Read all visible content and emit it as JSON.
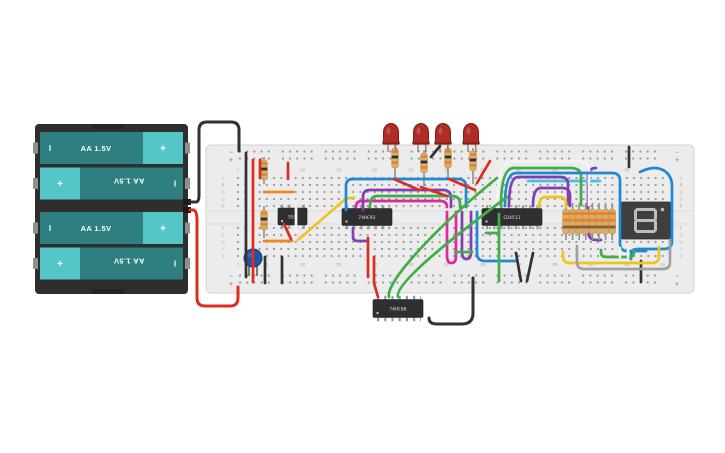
{
  "scene": {
    "background": "#ffffff",
    "width": 725,
    "height": 453
  },
  "battery": {
    "cell_label": "AA 1.5V",
    "plus_symbol": "+",
    "minus_symbol": "I",
    "cells": [
      {
        "flipped": false
      },
      {
        "flipped": true
      },
      {
        "flipped": false
      },
      {
        "flipped": true
      }
    ],
    "colors": {
      "holder": "#2e2e2e",
      "body": "#2e7f80",
      "cap": "#55c6c8"
    }
  },
  "breadboard": {
    "row_labels_top": [
      "A",
      "B",
      "C",
      "D",
      "E"
    ],
    "row_labels_bottom": [
      "F",
      "G",
      "H",
      "I",
      "J"
    ],
    "column_numbers": [
      1,
      5,
      10,
      15,
      20,
      25,
      30,
      35,
      40,
      45,
      50,
      55,
      60
    ],
    "rail_minus": "−",
    "rail_plus": "+",
    "colors": {
      "board": "#ececec",
      "hole": "#9c9c9c",
      "minus": "#5ba0d0",
      "plus": "#d05a5a"
    }
  },
  "circuit": {
    "ics": [
      {
        "id": "timer-555",
        "label": "555"
      },
      {
        "id": "counter-74hc93",
        "label": "74HC93"
      },
      {
        "id": "decoder-cd4511",
        "label": "CD4511"
      },
      {
        "id": "and-gate-74hc08",
        "label": "74HC08"
      }
    ],
    "display": {
      "type": "seven-segment-display",
      "unlit_segments": "all",
      "unlit_color": "#bdbdbd",
      "body_color": "#3f3f41"
    },
    "led_color": "#ad2c24",
    "leds": [
      {
        "x": 391
      },
      {
        "x": 421
      },
      {
        "x": 443
      },
      {
        "x": 471
      }
    ],
    "resistors": [
      {
        "x": 395,
        "lead": [
          145,
          180
        ],
        "body": [
          148,
          20
        ]
      },
      {
        "x": 424,
        "lead": [
          150,
          186
        ],
        "body": [
          153,
          20
        ]
      },
      {
        "x": 448,
        "lead": [
          145,
          180
        ],
        "body": [
          148,
          20
        ]
      },
      {
        "x": 473,
        "lead": [
          148,
          184
        ],
        "body": [
          151,
          20
        ]
      },
      {
        "x": 264,
        "lead": [
          157,
          184
        ],
        "body": [
          160,
          20
        ]
      },
      {
        "x": 264,
        "lead": [
          206,
          238
        ],
        "body": [
          210,
          20
        ]
      }
    ],
    "resistor_bands": [
      "#e8832a",
      "#2f2f2f",
      "#e8832a"
    ],
    "resistor_array": {
      "count": 8,
      "x0": 566,
      "pitch": 6.6,
      "lead": [
        203,
        240
      ],
      "body": [
        209,
        25
      ],
      "bands": [
        "#e8832a",
        "#e8832a",
        "#8a5a2a"
      ]
    },
    "capacitor": {
      "x": 253,
      "y": 258,
      "r": 9,
      "color": "#2155a3"
    },
    "wire_colors": {
      "red": "#dd2c20",
      "black": "#323232",
      "orange": "#ee8722",
      "yellow": "#eec41f",
      "green": "#3fae49",
      "blue": "#2188d4",
      "cyan": "#49c0e8",
      "purple": "#8040b0",
      "magenta": "#e0289e",
      "gray": "#a0a0a0",
      "white": "#f4f4f4"
    },
    "wires": [
      {
        "n": "power-purple-under",
        "c": "#8040b0",
        "layer": "under",
        "d": "M596,168 Q588,168 588,176 V230 Q588,240 596,240 H601"
      },
      {
        "n": "cyan-under",
        "c": "#49c0e8",
        "layer": "under",
        "d": "M528,181 H600"
      },
      {
        "n": "battery-negative",
        "c": "#323232",
        "w": 3,
        "d": "M190,202 H196 Q199,202 199,195 V130 Q199,122 207,122 H231 Q239,122 239,130 V151"
      },
      {
        "n": "battery-positive",
        "c": "#dd2c20",
        "w": 3,
        "d": "M190,210 H194 Q197,212 197,219 V298 Q197,306 205,306 H230 Q238,306 238,298 V287"
      },
      {
        "n": "rail-jumper-black",
        "c": "#323232",
        "d": "M246,153 V277"
      },
      {
        "n": "rail-jumper-red",
        "c": "#dd2c20",
        "d": "M253,160 V282"
      },
      {
        "n": "red-v1",
        "c": "#dd2c20",
        "d": "M260,160 V178"
      },
      {
        "n": "red-v2",
        "c": "#dd2c20",
        "d": "M288,163 V179"
      },
      {
        "n": "orange-1",
        "c": "#ee8722",
        "d": "M264,192 H293"
      },
      {
        "n": "orange-2",
        "c": "#ee8722",
        "d": "M264,241 H292"
      },
      {
        "n": "white-555",
        "c": "#f4f4f4",
        "d": "M296,201 V231"
      },
      {
        "n": "red-555",
        "c": "#dd2c20",
        "d": "M284,224 L291,239"
      },
      {
        "n": "yellow-555",
        "c": "#eec41f",
        "d": "M298,240 L343,201 Q346,198 351,198 H354"
      },
      {
        "n": "purple-93",
        "c": "#8040b0",
        "d": "M353,228 V237 Q353,241 358,241 H366"
      },
      {
        "n": "magenta-bus",
        "c": "#e0289e",
        "d": "M356,207 Q356,201 362,201 H440 Q447,201 447,207"
      },
      {
        "n": "blue-bus",
        "c": "#2188d4",
        "d": "M346,210 V186 Q346,179 353,179 H458 Q466,179 466,187 V207"
      },
      {
        "n": "purple-bus",
        "c": "#8040b0",
        "d": "M363,210 V197 Q363,190 370,190 H443 Q451,190 451,198 V207"
      },
      {
        "n": "green-bus",
        "c": "#3fae49",
        "d": "M370,207 Q370,196 377,196 H452 Q460,196 460,204 V207"
      },
      {
        "n": "red-mid",
        "c": "#dd2c20",
        "d": "M368,238 V277"
      },
      {
        "n": "magenta-u",
        "c": "#e0289e",
        "d": "M447,212 V256 Q447,263 451.5,263 Q456,263 456,256 V212"
      },
      {
        "n": "purple-u",
        "c": "#8040b0",
        "d": "M462,212 V252 Q462,259 466.5,259 Q471,259 471,252 V212"
      },
      {
        "n": "blue-u",
        "c": "#2188d4",
        "d": "M477,212 V253 Q477,261 485,261 H516"
      },
      {
        "n": "green-h",
        "c": "#3fae49",
        "d": "M486,233 H499"
      },
      {
        "n": "green-v",
        "c": "#3fae49",
        "d": "M499,214 V281"
      },
      {
        "n": "green-h2",
        "c": "#3fae49",
        "d": "M455,252 H472"
      },
      {
        "n": "black-diag1",
        "c": "#323232",
        "d": "M516,253 L521,281"
      },
      {
        "n": "black-diag2",
        "c": "#323232",
        "d": "M533,253 L527,281"
      },
      {
        "n": "white-arc",
        "c": "#f4f4f4",
        "d": "M497,206 Q497,161 513,161 H575 Q589,161 589,170 V205"
      },
      {
        "n": "green-arc",
        "c": "#3fae49",
        "d": "M501,206 Q501,168 514,168 H570 Q581,168 581,176 V205"
      },
      {
        "n": "blue-arc-long",
        "c": "#2188d4",
        "d": "M505,206 Q505,173 516,173 H612 Q620,173 620,181 V243 Q620,251 627,251 H646"
      },
      {
        "n": "purple-arc1",
        "c": "#8040b0",
        "d": "M509,206 Q509,177 518,177 H560 Q568,177 568,184 V204"
      },
      {
        "n": "purple-arc2",
        "c": "#8040b0",
        "d": "M533,206 Q533,188 541,188 H562 Q570,188 570,196 V206"
      },
      {
        "n": "yellow-arc",
        "c": "#eec41f",
        "d": "M539,207 Q539,197 546,197 H559 Q566,197 566,204 V207"
      },
      {
        "n": "blue-right",
        "c": "#2188d4",
        "d": "M640,172 Q656,164 666,172 Q672,177 672,186 V241 Q672,249 664,249 H638 Q631,249 631,255 V259"
      },
      {
        "n": "black-v-top",
        "c": "#323232",
        "d": "M629,147 V167"
      },
      {
        "n": "black-v-bot",
        "c": "#323232",
        "d": "M641,261 V282"
      },
      {
        "n": "yellow-u",
        "c": "#eec41f",
        "d": "M563,252 V256 Q563,263 570,263 H652 Q659,263 659,256 V247"
      },
      {
        "n": "gray-u",
        "c": "#a0a0a0",
        "d": "M577,246 V262 Q577,269 584,269 H663 Q670,269 670,262 V240"
      },
      {
        "n": "green-u",
        "c": "#3fae49",
        "d": "M601,250 V252 Q601,257 606,257 H629 Q634,257 634,252 V250"
      },
      {
        "n": "white-stub1",
        "c": "#f4f4f4",
        "d": "M620,248 V257"
      },
      {
        "n": "white-stub2",
        "c": "#f4f4f4",
        "d": "M628,248 V257"
      },
      {
        "n": "red-to-7408",
        "c": "#dd2c20",
        "d": "M374,257 V283 L378,297"
      },
      {
        "n": "green-diag1",
        "c": "#3fae49",
        "d": "M389,297 C385,282 438,226 497,178"
      },
      {
        "n": "green-diag2",
        "c": "#3fae49",
        "d": "M398,297 C394,284 452,238 507,197"
      },
      {
        "n": "black-7408-loop",
        "c": "#323232",
        "w": 3,
        "d": "M473,278 V313 Q473,324 462,324 H437 Q429,324 429,318"
      },
      {
        "n": "red-led1",
        "c": "#dd2c20",
        "d": "M394,179 L419,190"
      },
      {
        "n": "red-led2",
        "c": "#dd2c20",
        "d": "M421,187 L447,196"
      },
      {
        "n": "red-led3",
        "c": "#dd2c20",
        "d": "M449,179 L475,190"
      },
      {
        "n": "red-led4",
        "c": "#dd2c20",
        "d": "M477,183 L490,161"
      },
      {
        "n": "black-led",
        "c": "#323232",
        "d": "M440,146 L431,157"
      },
      {
        "n": "black-bl1",
        "c": "#323232",
        "d": "M265,257 V283"
      },
      {
        "n": "black-bl2",
        "c": "#323232",
        "d": "M282,257 V283"
      }
    ]
  }
}
